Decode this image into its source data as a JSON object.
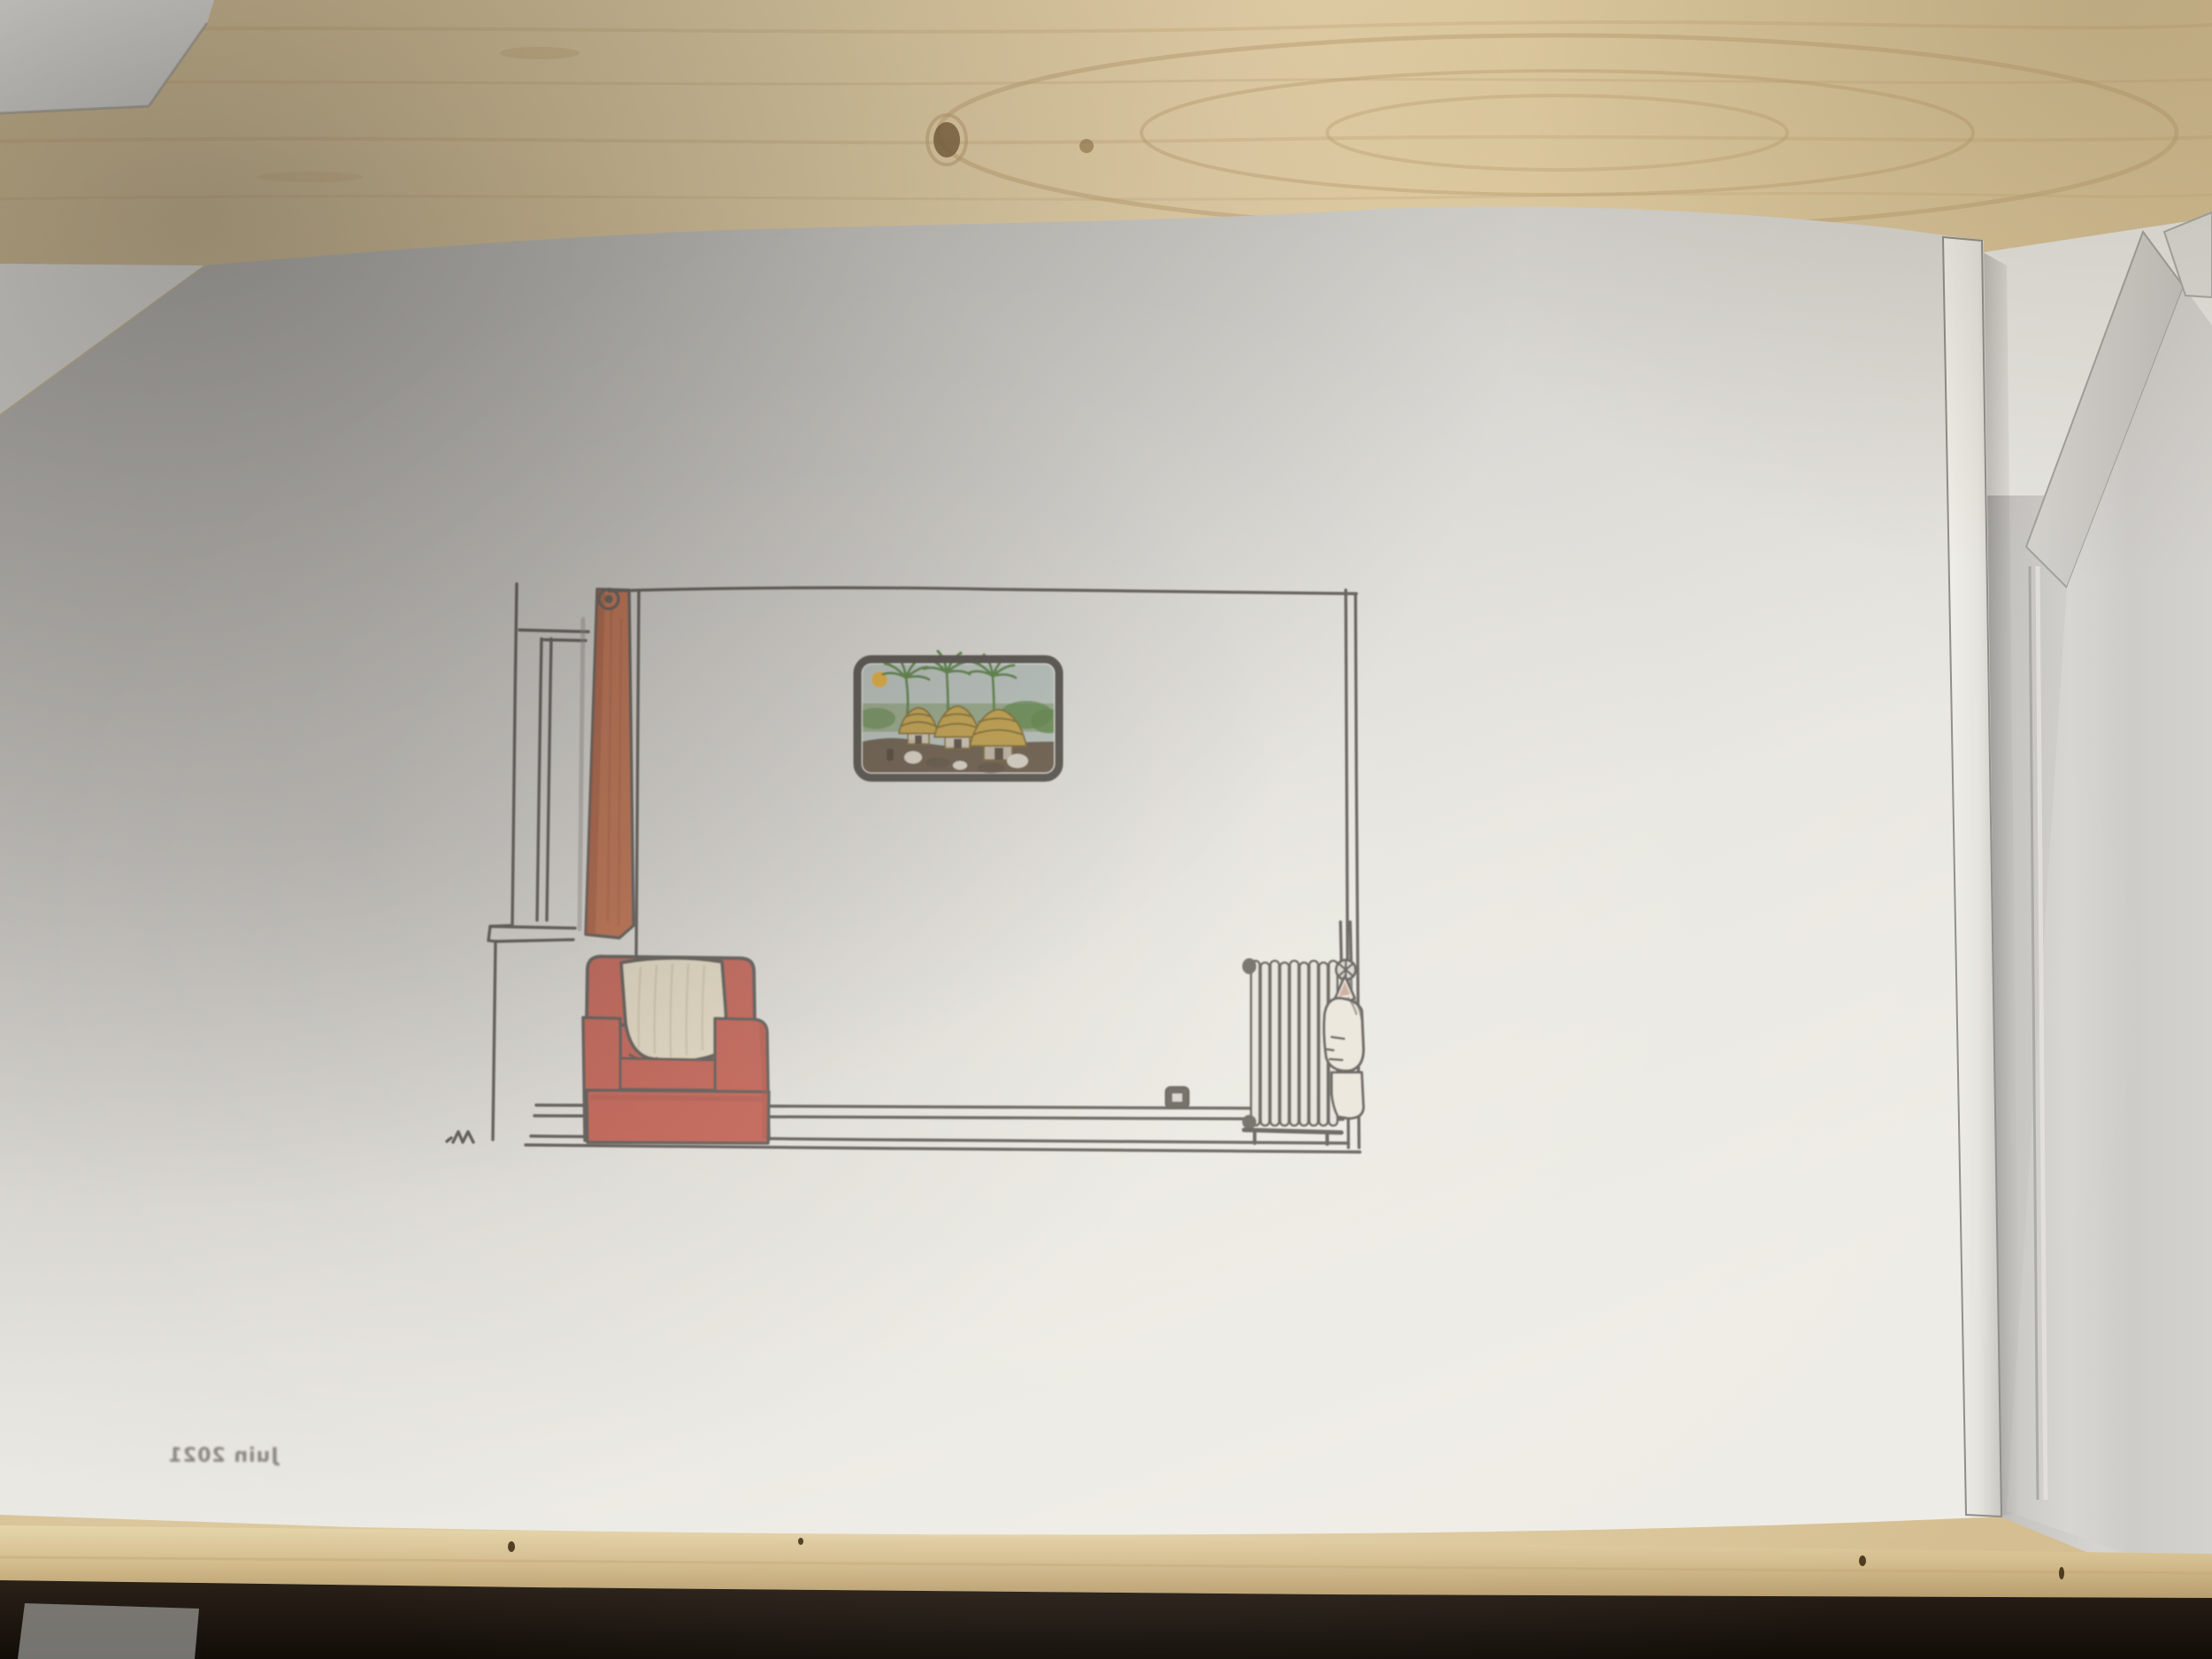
{
  "photo": {
    "description": "hand drawing on translucent sheet in a sketchbook lying on a pale wooden desk",
    "caption": {
      "text": "Juin 2021",
      "mirrored": true
    }
  },
  "drawing": {
    "subject": "living-room interior sketch",
    "parts": [
      "window-frame",
      "orange-curtain",
      "room-outline",
      "framed-tropical-picture",
      "sun",
      "palm-trees",
      "thatched-huts",
      "red-armchair",
      "cream-blanket",
      "radiator",
      "radiator-valve",
      "figure-peeking-behind-radiator",
      "wall-outlet",
      "artist-mark"
    ]
  },
  "colors": {
    "ink": "#55514d",
    "wood-base": "#decaa0",
    "wood-grain": "#bfa274",
    "wood-knot": "#7e6440",
    "table-edge": "#d4bd8e",
    "under-table": "#17110b",
    "sheet-light": "#eeece6",
    "sheet-dark": "#b6b4b0",
    "page-gray": "#d6d4d0",
    "card-white": "#ebe9e5",
    "curtain": "#bf6742",
    "curtain-dark": "#9c4e30",
    "armchair": "#c65a4c",
    "armchair-dark": "#a84a3e",
    "blanket": "#e9dfc7",
    "blanket-stripe": "#cfc5a8",
    "pic-frame": "#47423c",
    "pic-sky": "#b5bfb9",
    "pic-sun": "#e2a92f",
    "pic-palm": "#4e7a36",
    "pic-hut": "#c09b3d",
    "pic-ground": "#5f4f3d",
    "radiator-fill": "#e6e3dc",
    "figure-skin": "#ece6db",
    "ear-inner": "#bb8f7d",
    "caption-ink": "#77746f"
  }
}
